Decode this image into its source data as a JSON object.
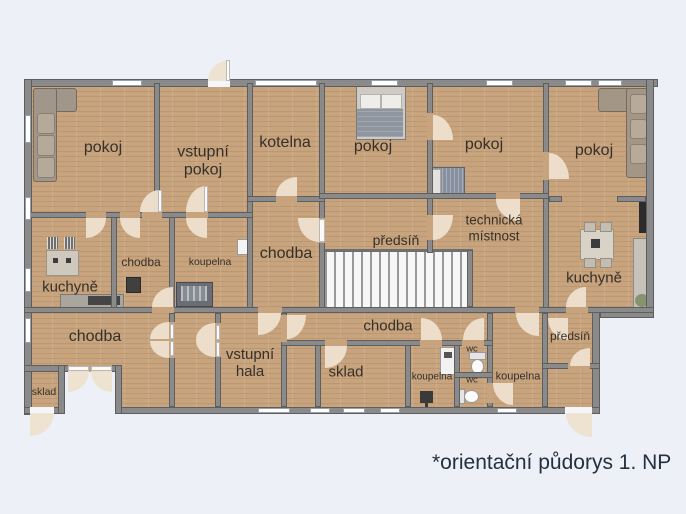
{
  "page": {
    "background": "#edf0f6",
    "type": "floor-plan"
  },
  "footer": {
    "note": "*orientační půdorys 1. NP"
  },
  "palette": {
    "background": "#edf0f6",
    "floor": "#c8a47e",
    "wall": "#8a8a8a",
    "wall_edge": "#5e5e5e",
    "window": "#ffffff",
    "door_swing": "#eee2cf",
    "label_text": "#35302a",
    "footer_text": "#25303f"
  },
  "rooms": {
    "pokoj_top_left": {
      "label": "pokoj"
    },
    "vstupni_pokoj": {
      "label": "vstupní pokoj"
    },
    "kotelna": {
      "label": "kotelna"
    },
    "pokoj_top_center": {
      "label": "pokoj"
    },
    "pokoj_top_center2": {
      "label": "pokoj"
    },
    "pokoj_top_right": {
      "label": "pokoj"
    },
    "kuchyne_left": {
      "label": "kuchyně"
    },
    "chodba_small": {
      "label": "chodba"
    },
    "koupelna_small": {
      "label": "koupelna"
    },
    "chodba_center": {
      "label": "chodba"
    },
    "predsin_center": {
      "label": "předsíň"
    },
    "technicka_mistnost": {
      "label": "technická místnost"
    },
    "kuchyne_right": {
      "label": "kuchyně"
    },
    "chodba_bottom_left": {
      "label": "chodba"
    },
    "sklad_left": {
      "label": "sklad"
    },
    "vstupni_hala": {
      "label": "vstupní hala"
    },
    "chodba_bottom_center": {
      "label": "chodba"
    },
    "sklad_center": {
      "label": "sklad"
    },
    "koupelna_bottom": {
      "label": "koupelna"
    },
    "wc_top": {
      "label": "wc"
    },
    "wc_bottom": {
      "label": "wc"
    },
    "koupelna_right": {
      "label": "koupelna"
    },
    "predsin_right": {
      "label": "předsíň"
    }
  }
}
